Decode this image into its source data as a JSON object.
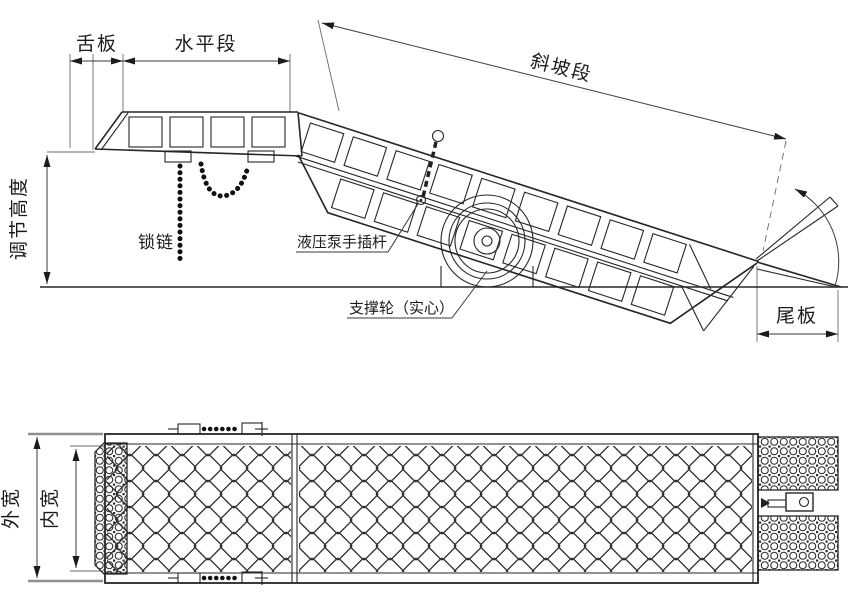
{
  "colors": {
    "ink": "#262626",
    "paper": "#ffffff",
    "dim_line": "#3a3a3a"
  },
  "side_view": {
    "tongue_label": "舌板",
    "horizontal_label": "水平段",
    "slope_label": "斜坡段",
    "height_label": "调节高度",
    "chain_label": "锁链",
    "pump_label": "液压泵手插杆",
    "wheel_label": "支撑轮（实心）",
    "tail_label": "尾板"
  },
  "plan_view": {
    "outer_width_label": "外宽",
    "inner_width_label": "内宽"
  }
}
